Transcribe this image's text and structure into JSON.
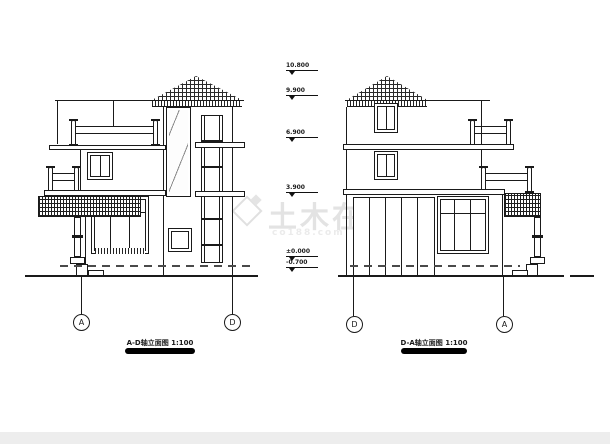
{
  "watermark": {
    "icon": "diamond-logo",
    "text": "土木在线",
    "subtext": "co188.com"
  },
  "elevation_markers": [
    {
      "value": "10.800"
    },
    {
      "value": "9.900"
    },
    {
      "value": "6.900"
    },
    {
      "value": "3.900"
    },
    {
      "value": "±0.000"
    },
    {
      "value": "-0.700"
    }
  ],
  "left_drawing": {
    "caption": "A-D轴立面图 1:100",
    "bubbles": [
      "A",
      "D"
    ]
  },
  "right_drawing": {
    "caption": "D-A轴立面图 1:100",
    "bubbles": [
      "D",
      "A"
    ]
  }
}
